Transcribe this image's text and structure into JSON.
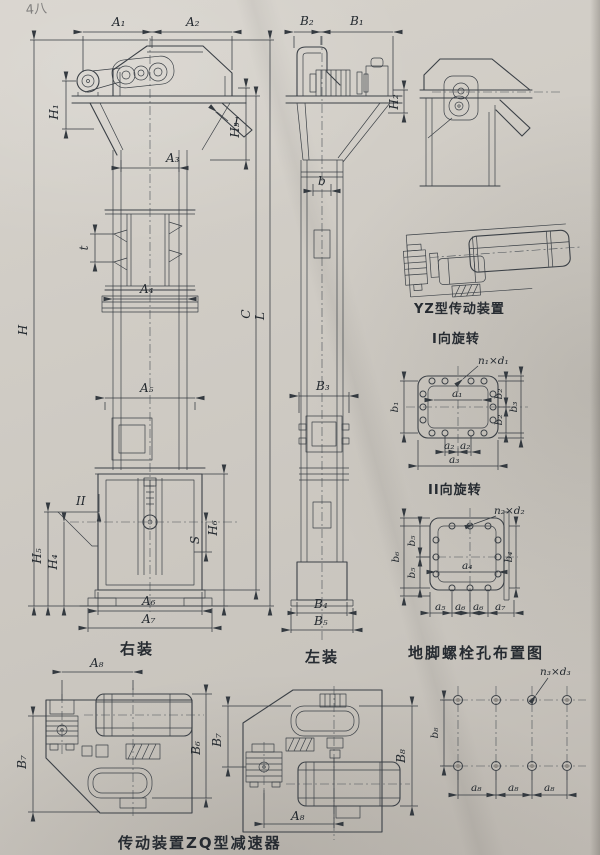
{
  "page": {
    "corner_note": "4八",
    "colors": {
      "paper": "#cfcbc4",
      "ink": "#3b4046"
    }
  },
  "captions": {
    "right_install": "右装",
    "left_install": "左装",
    "yz_drive": "YZ型传动装置",
    "rotation_i": "I向旋转",
    "rotation_ii": "II向旋转",
    "anchor_bolts": "地脚螺栓孔布置图",
    "zq_drive": "传动装置ZQ型减速器"
  },
  "front_view": {
    "A1": "A₁",
    "A2": "A₂",
    "A3": "A₃",
    "A4": "A₄",
    "A5": "A₅",
    "A6": "A₆",
    "A7": "A₇",
    "H": "H",
    "H1": "H₁",
    "H3": "H₃",
    "H4": "H₄",
    "H5": "H₅",
    "H6": "H₆",
    "S": "S",
    "t": "t",
    "C": "C",
    "L": "L",
    "section_I": "I",
    "section_II": "II"
  },
  "side_view": {
    "B1": "B₁",
    "B2": "B₂",
    "B3": "B₃",
    "B4": "B₄",
    "B5": "B₅",
    "b": "b",
    "H2": "H₂"
  },
  "bolt_plan_1": {
    "n1d1": "n₁×d₁",
    "a1": "a₁",
    "a2": "a₂",
    "a3": "a₃",
    "b1": "b₁",
    "b2": "b₂",
    "b3": "b₃"
  },
  "bolt_plan_2": {
    "n2d2": "n₂×d₂",
    "a4": "a₄",
    "a5": "a₅",
    "a6": "a₆",
    "a7": "a₇",
    "b4": "b₄",
    "b5": "b₅",
    "b6": "b₆"
  },
  "bolt_grid": {
    "n3d3": "n₃×d₃",
    "a8": "a₈",
    "b8": "b₈"
  },
  "zq_left_view": {
    "A8": "A₈",
    "B6": "B₆",
    "B7": "B₇"
  },
  "zq_right_view": {
    "A8": "A₈",
    "B7": "B₇",
    "B8": "B₈"
  }
}
